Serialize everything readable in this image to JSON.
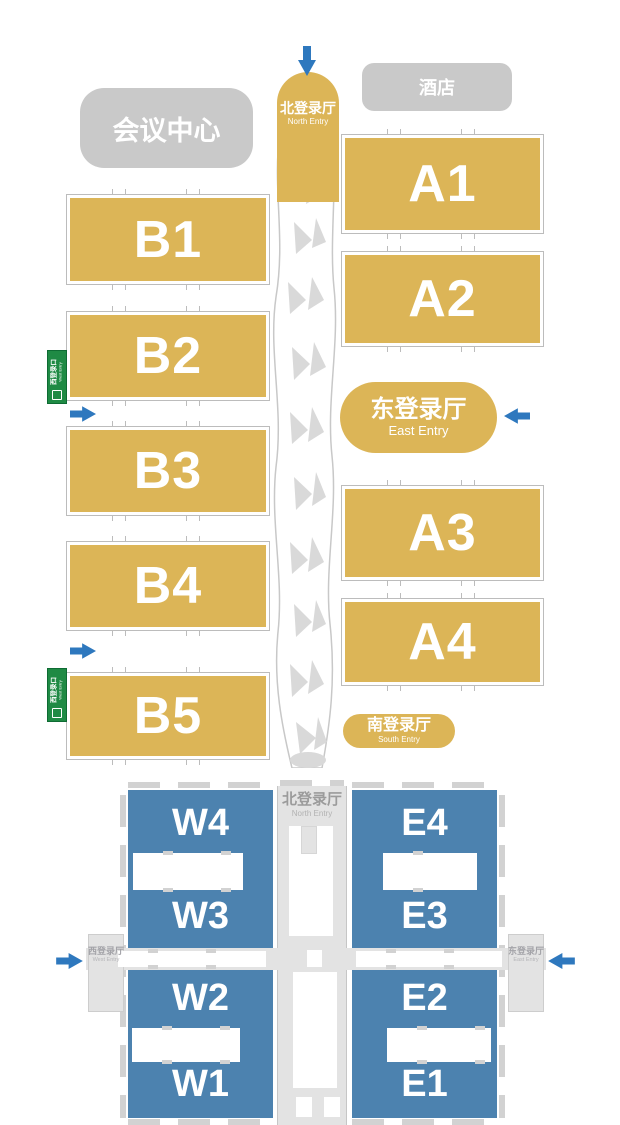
{
  "colors": {
    "hall_gold": "#dcb557",
    "hall_blue": "#4c82af",
    "arrow_blue": "#2e78be",
    "building_gray": "#c9c9c9",
    "corridor_gray": "#e3e3e3",
    "entry_sign_green": "#1f8a44"
  },
  "upper_map": {
    "north_entry": {
      "zh": "北登录厅",
      "en": "North Entry"
    },
    "hotel_label": "酒店",
    "conference_center_label": "会议中心",
    "east_entry": {
      "zh": "东登录厅",
      "en": "East Entry"
    },
    "south_entry": {
      "zh": "南登录厅",
      "en": "South Entry"
    },
    "halls_a": [
      "A1",
      "A2",
      "A3",
      "A4"
    ],
    "halls_b": [
      "B1",
      "B2",
      "B3",
      "B4",
      "B5"
    ],
    "side_gate_signs": [
      {
        "zh": "西登录口",
        "en": "West Entry"
      },
      {
        "zh": "西登录口",
        "en": "West Entry"
      }
    ]
  },
  "lower_map": {
    "north_entry": {
      "zh": "北登录厅",
      "en": "North Entry"
    },
    "west_entry": {
      "zh": "西登录厅",
      "en": "West Entry"
    },
    "east_entry": {
      "zh": "东登录厅",
      "en": "East Entry"
    },
    "west_halls": [
      "W4",
      "W3",
      "W2",
      "W1"
    ],
    "east_halls": [
      "E4",
      "E3",
      "E2",
      "E1"
    ]
  }
}
